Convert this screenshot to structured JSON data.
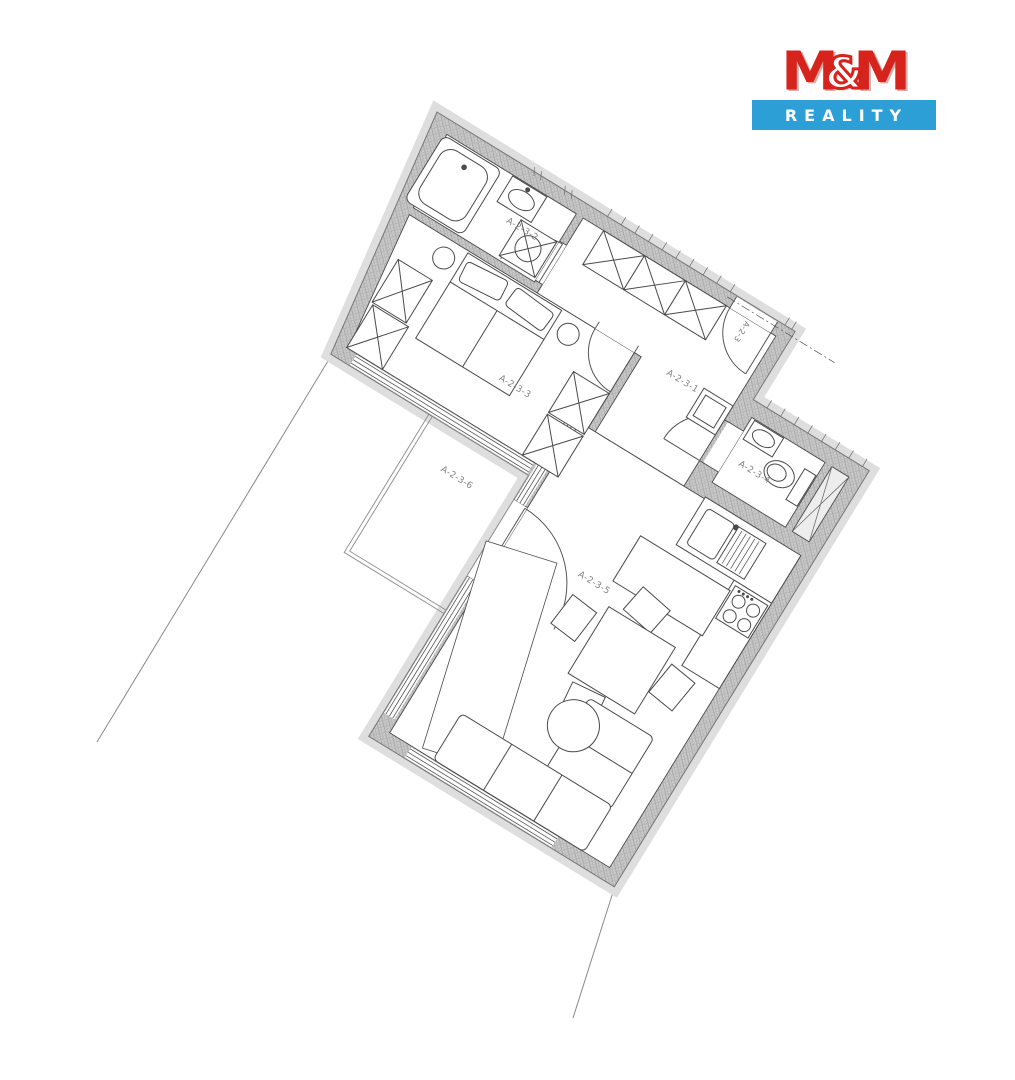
{
  "logo": {
    "m_left": "M",
    "ampersand": "&",
    "m_right": "M",
    "subtitle": "REALITY",
    "brand_red": "#d6231c",
    "brand_blue": "#2b9fd6"
  },
  "floor_plan": {
    "unit_label": "A-2-3",
    "rooms": [
      {
        "label": "A-2-3-1"
      },
      {
        "label": "A-2-3-2"
      },
      {
        "label": "A-2-3-3"
      },
      {
        "label": "A-2-3-4"
      },
      {
        "label": "A-2-3-5"
      },
      {
        "label": "A-2-3-6"
      }
    ]
  }
}
